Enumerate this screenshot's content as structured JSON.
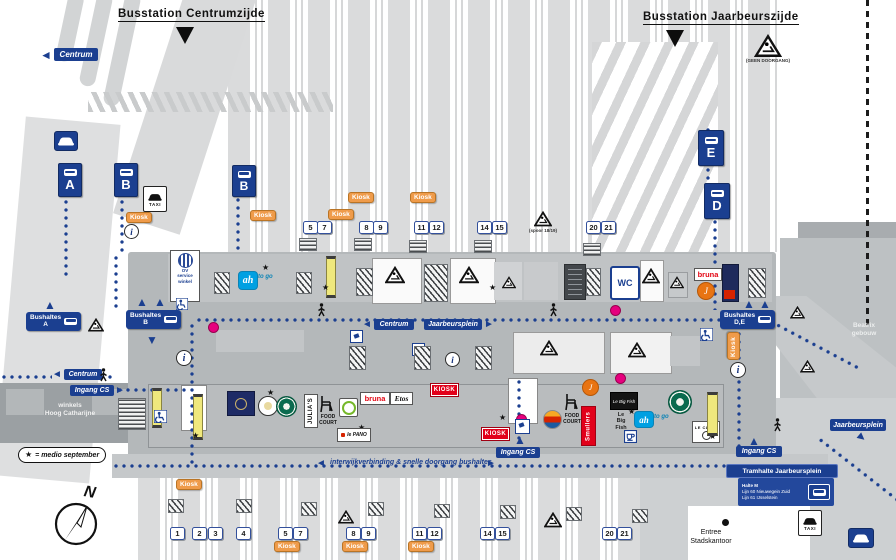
{
  "titles": {
    "centrumzijde": "Busstation Centrumzijde",
    "jaarbeurszijde": "Busstation Jaarbeurszijde"
  },
  "bus": {
    "stop_a": "A",
    "stop_b": "B",
    "stop_d": "D",
    "stop_e": "E",
    "haltes_a": "Bushaltes\nA",
    "haltes_b": "Bushaltes\nB",
    "haltes_de": "Bushaltes\nD,E"
  },
  "signs": {
    "centrum": "Centrum",
    "jaarbeursplein": "Jaarbeursplein",
    "ingang_cs": "Ingang CS",
    "interwijk": "interwijkverbinding & snelle doorgang bushaltes"
  },
  "tram": {
    "title": "Tramhalte Jaarbeursplein",
    "halte": "Halte M",
    "lijn60": "Lijn 60 Nieuwegein Zuid",
    "lijn61": "Lijn 61 IJsselstein"
  },
  "platforms": {
    "top": [
      "5",
      "7",
      "8",
      "9",
      "11",
      "12",
      "14",
      "15",
      "20",
      "21"
    ],
    "bottom": [
      "1",
      "2",
      "3",
      "4",
      "5",
      "7",
      "8",
      "9",
      "11",
      "12",
      "14",
      "15",
      "20",
      "21"
    ]
  },
  "shops": {
    "ah": "ah",
    "to_go": "to go",
    "bruna": "bruna",
    "etos": "Etos",
    "kiosk": "KIOSK",
    "smullers": "Smullers",
    "julias": "JULIA'S",
    "food_court": "FOOD\nCOURT",
    "le_big_fish_logo": "Le Big Fish",
    "le_big_fish": "Le\nBig\nFish",
    "le_pano": "le PANO",
    "le_clair": "LE CLAIR"
  },
  "facilities": {
    "wc": "WC",
    "taxi": "TAXI",
    "kiosk_tag": "Kiosk",
    "ov_service": "OV\nservice\nwinkel",
    "info": "i"
  },
  "places": {
    "hoog_catharijne": "winkels\nHoog Catharijne",
    "beatrix": "Beatrix\ngebouw",
    "stadskantoor": "Entree\nStadskantoor"
  },
  "notes": {
    "geen_doorgang": "(GEEN DOORGANG)",
    "spoor": "(spoor 18/19)",
    "medio": "= medio september",
    "star": "★"
  },
  "glyphs": {
    "left": "◄",
    "right": "►",
    "up": "▲",
    "down": "▼"
  },
  "compass": {
    "n": "N"
  }
}
